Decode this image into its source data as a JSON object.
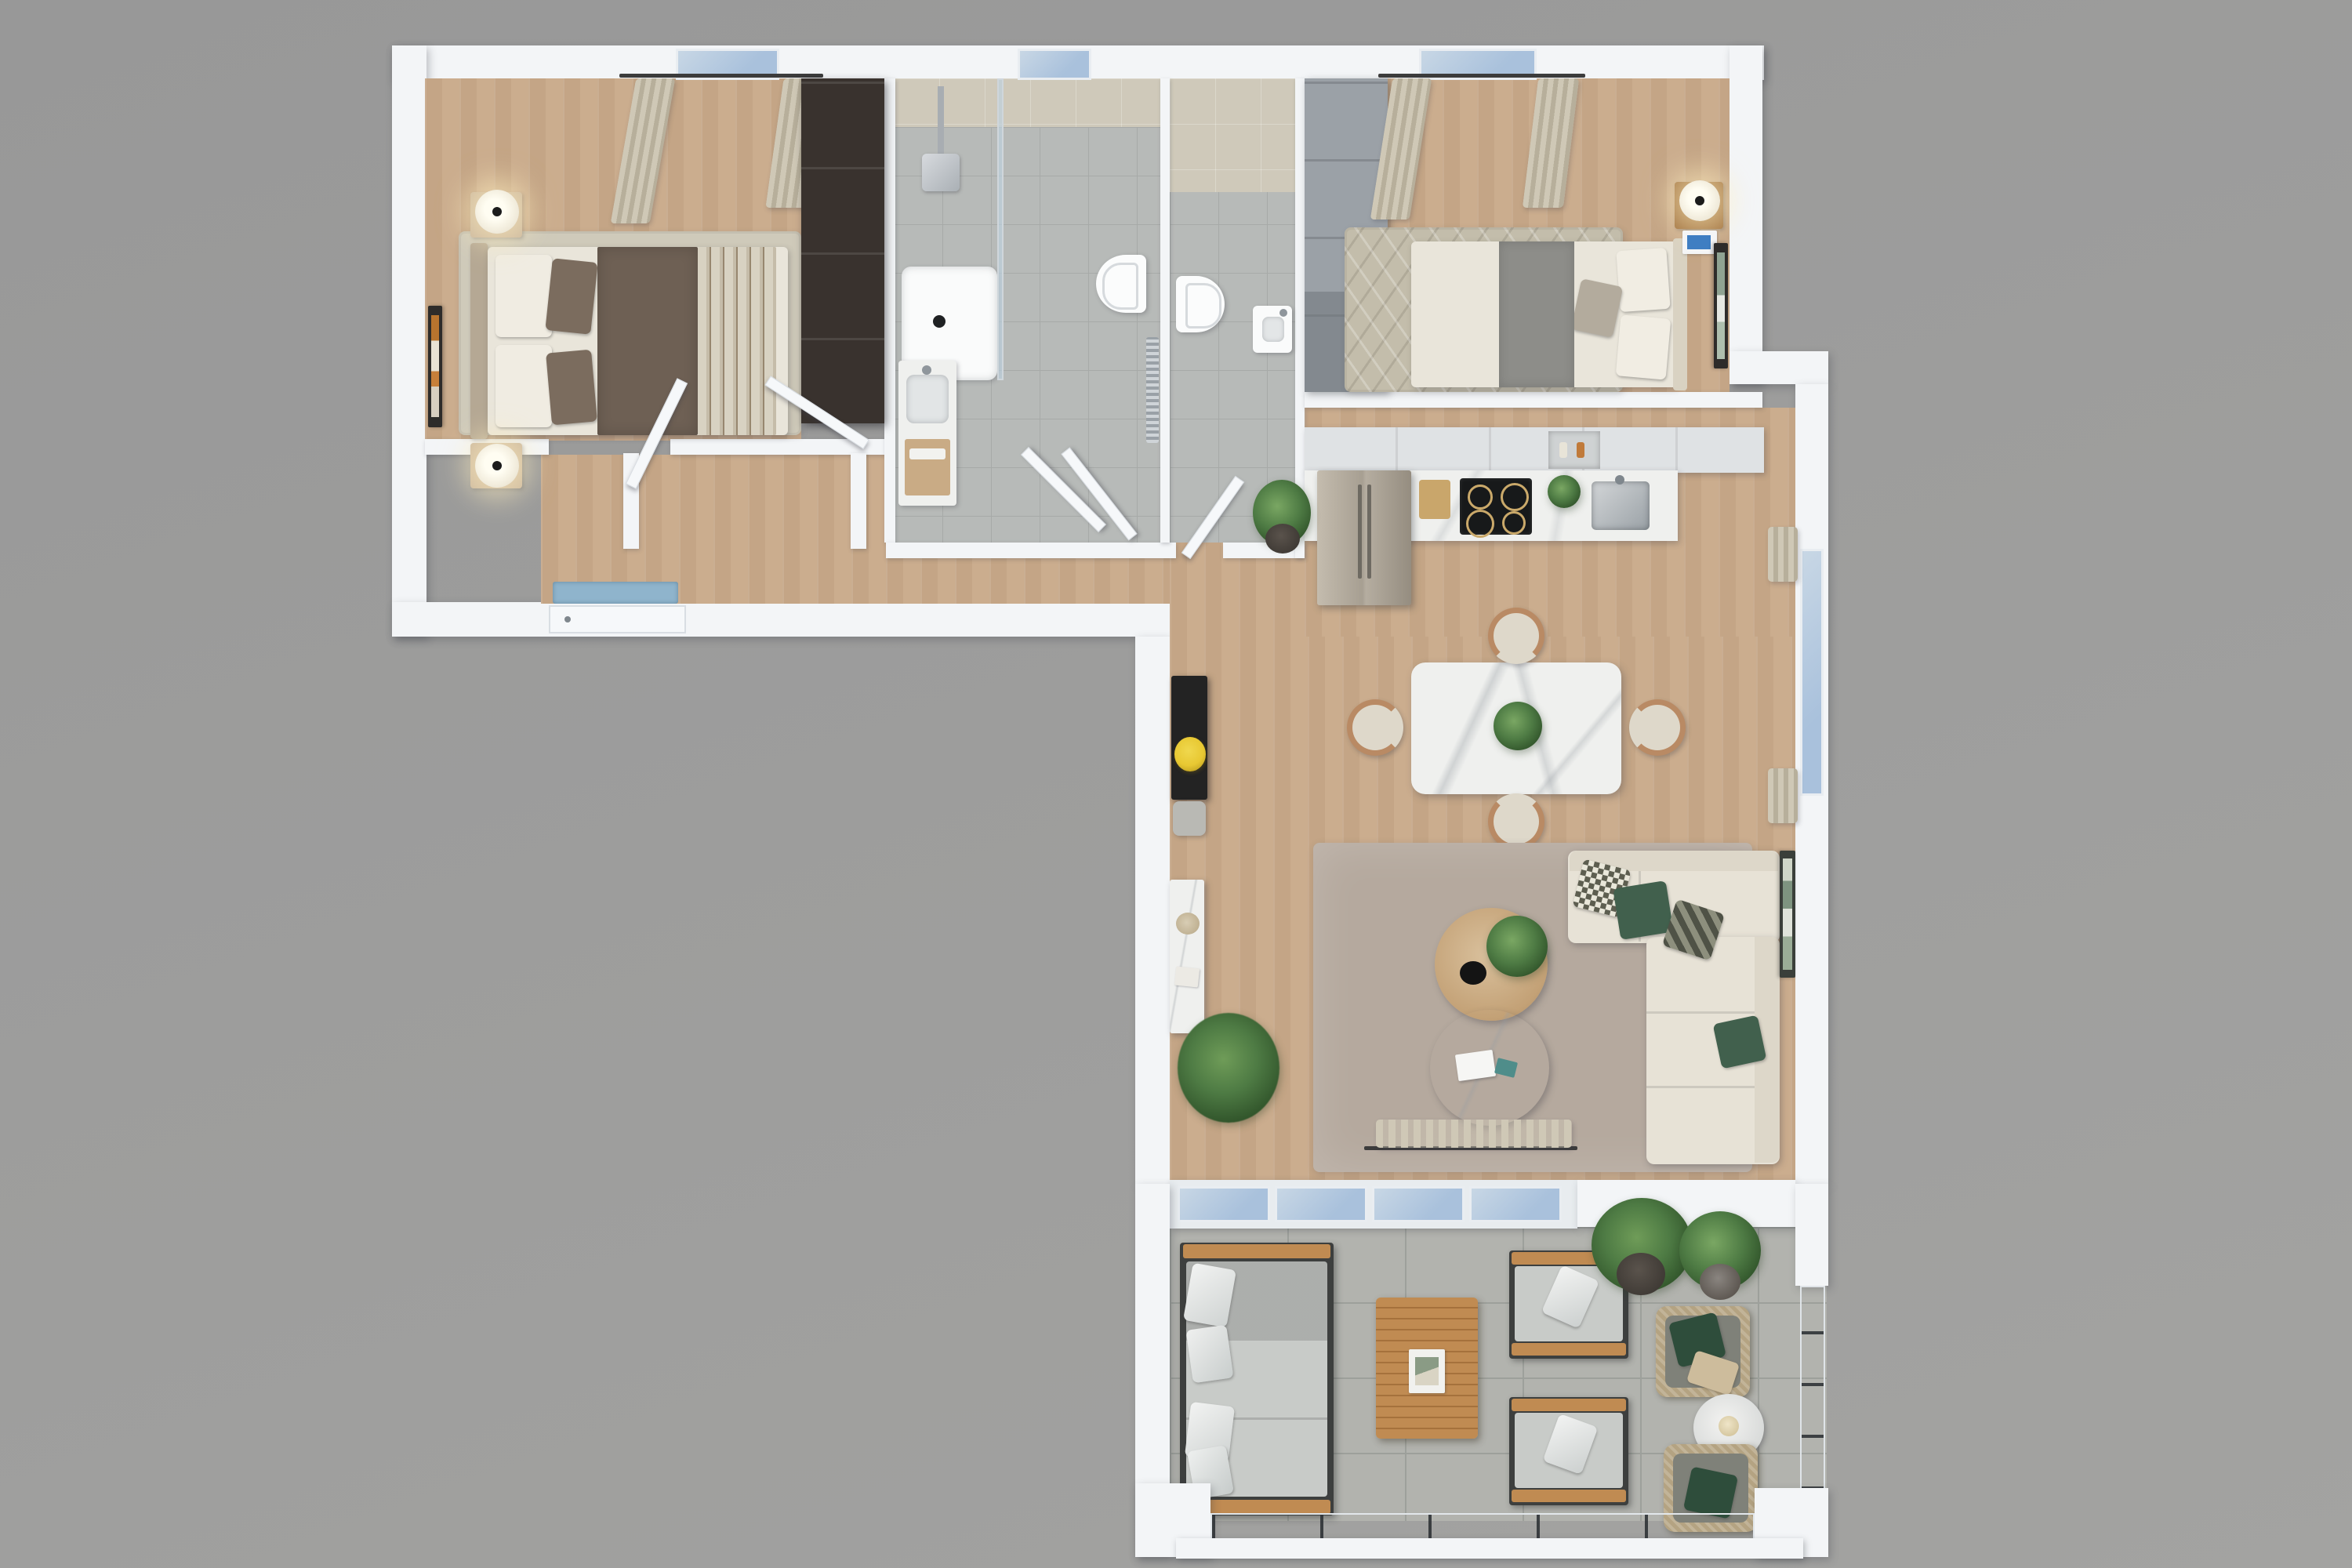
{
  "scene": {
    "type": "3d-floorplan-render",
    "description": "Top-down 3D rendering of an L-shaped apartment with two bedrooms, bathroom, WC, hallway, open kitchen-dining-living area and a furnished terrace",
    "visible_text": ""
  },
  "colors": {
    "bg1": "#989898",
    "bg2": "#a3a3a1",
    "wall": "#f3f5f7",
    "wall_face": "#e3e8ed",
    "wood": "#cbad8e",
    "wood_light": "#d4ba9d",
    "tile_bath": "#b7bab8",
    "tile_grout": "#a7aaa8",
    "tile_wall": "#cfc9ba",
    "terrace_tile": "#b2b3ae",
    "terrace_grout": "#9da09b",
    "glass": "#a9c1dc",
    "glass_light": "#c8d7e5",
    "curtain": "#cfc8b6",
    "curtain_dark": "#b7af9b",
    "rug_bed1": "#cfcaba",
    "rug_bed2": "#c3bdab",
    "rug_living": "#b5a99e",
    "linen": "#e9e5da",
    "blanket_brown": "#6e6054",
    "pillow_brown": "#7b6c5e",
    "throw_stripe": "#d8d2c2",
    "runner_gray": "#8d8d89",
    "sofa": "#e7e2d6",
    "pillow_green": "#41604d",
    "pillow_check": "#9fa08f",
    "wardrobe_dark": "#39322e",
    "wardrobe_gray": "#9ba1a7",
    "marble": "#eff0ee",
    "marble_vein": "#c9cdd2",
    "cabinet": "#eef0f1",
    "cabinet_top": "#dfe2e4",
    "steel": "#b8b2a6",
    "cooktop": "#17191a",
    "teak": "#c08b52",
    "teak_dark": "#a5713c",
    "out_cushion": "#c8cbc8",
    "out_frame": "#3d3f3e",
    "rattan": "#b4a382",
    "rattan_cushion": "#7f8179",
    "plant": "#4e7b44",
    "plant_dark": "#2f5229",
    "pot_dark": "#3f3a35",
    "chair_tan": "#b98a64",
    "chair_seat": "#ded8ca",
    "black_console": "#232323",
    "flower_yellow": "#e8c832",
    "door": "#f6f8fa",
    "doormat": "#8fb4cc"
  },
  "rooms": {
    "bedroom1": {
      "label": "bedroom-1",
      "floor": "wood",
      "furniture": [
        "double-bed",
        "brown-blanket",
        "striped-throw",
        "nightstand-2x",
        "table-lamp-2x",
        "wall-art",
        "area-rug",
        "window-curtains",
        "dark-wardrobe"
      ]
    },
    "bathroom": {
      "label": "bathroom",
      "floor": "gray-tile",
      "furniture": [
        "walk-in-shower",
        "glass-screen",
        "rain-shower-head",
        "shower-tray",
        "window",
        "wall-hung-toilet",
        "towel-radiator",
        "vanity-washbasin"
      ]
    },
    "wc": {
      "label": "wc",
      "floor": "gray-tile",
      "furniture": [
        "wall-hung-toilet",
        "corner-washbasin",
        "door"
      ]
    },
    "bedroom2": {
      "label": "bedroom-2",
      "floor": "wood",
      "furniture": [
        "double-bed",
        "gray-runner",
        "nightstand",
        "table-lamp",
        "books",
        "wall-art",
        "patterned-rug",
        "window-curtains",
        "gray-wardrobe"
      ]
    },
    "hallway": {
      "label": "hallway",
      "floor": "wood",
      "furniture": [
        "entry-door",
        "doormat",
        "open-door-2x",
        "closet-partition"
      ]
    },
    "kitchen": {
      "label": "kitchen",
      "floor": "wood",
      "furniture": [
        "fridge-freezer",
        "tall-cabinets",
        "shelf-niche",
        "marble-counter",
        "induction-cooktop",
        "sink-faucet",
        "cutting-board",
        "potted-plant"
      ]
    },
    "dining": {
      "label": "dining-area",
      "floor": "wood",
      "furniture": [
        "marble-dining-table",
        "dining-chair-4x",
        "centerpiece-plant",
        "window-curtains"
      ]
    },
    "living": {
      "label": "living-room",
      "floor": "wood",
      "furniture": [
        "corner-sofa",
        "green-pillows",
        "round-wood-coffee-table",
        "round-marble-coffee-table",
        "black-console",
        "bench",
        "tv-cabinet",
        "palm-plant",
        "wall-art",
        "area-rug",
        "sheer-curtain"
      ]
    },
    "terrace": {
      "label": "terrace",
      "floor": "stone-tile",
      "furniture": [
        "sliding-glass-doors",
        "outdoor-sofa",
        "teak-coffee-table",
        "lounge-chair-2x",
        "rattan-chair-2x",
        "marble-bistro-table",
        "potted-palm",
        "potted-shrub",
        "glass-balustrade"
      ]
    }
  }
}
